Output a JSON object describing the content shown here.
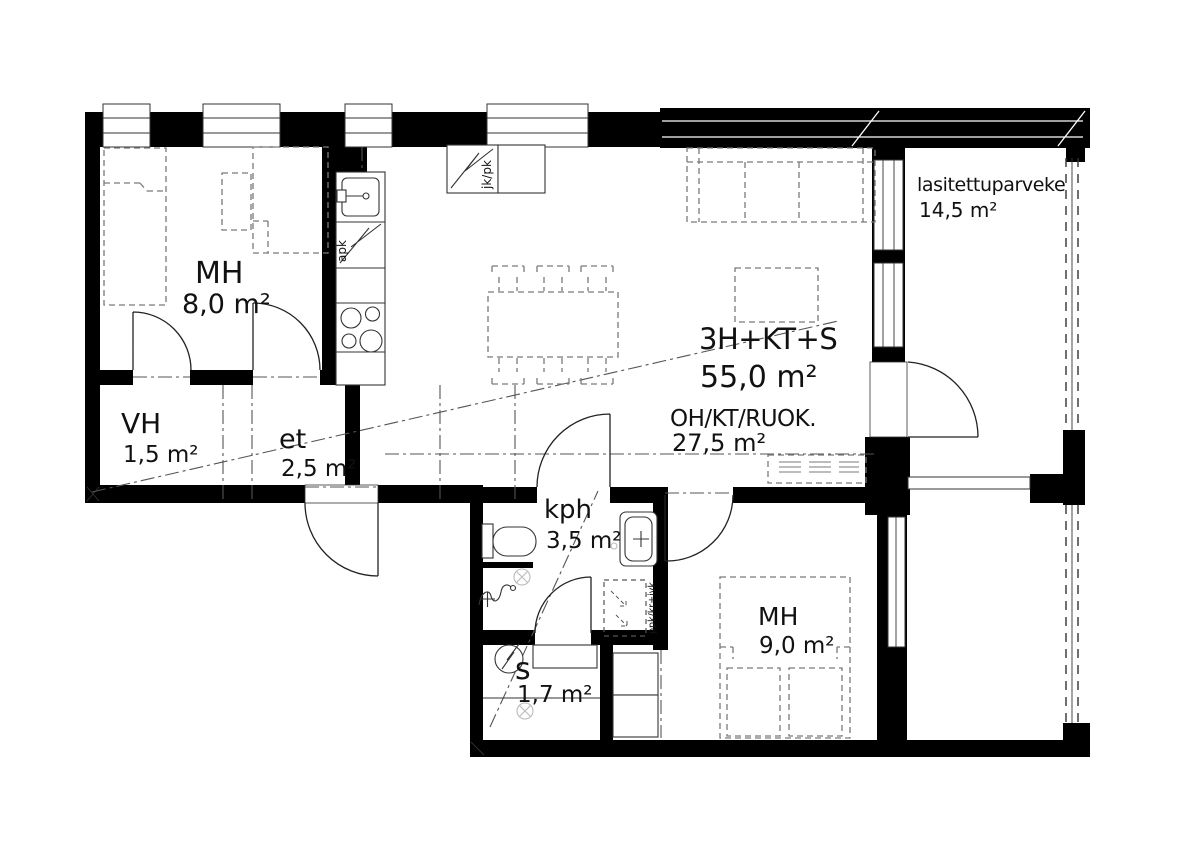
{
  "apartment": {
    "type_label": "3H+KT+S",
    "area": "55,0 m²"
  },
  "rooms": {
    "bedroom1": {
      "label": "MH",
      "area": "8,0 m²"
    },
    "closet": {
      "label": "VH",
      "area": "1,5 m²"
    },
    "entry": {
      "label": "et",
      "area": "2,5 m²"
    },
    "living": {
      "label": "OH/KT/RUOK.",
      "area": "27,5 m²"
    },
    "bathroom": {
      "label": "kph",
      "area": "3,5 m²"
    },
    "sauna": {
      "label": "s",
      "area": "1,7 m²"
    },
    "bedroom2": {
      "label": "MH",
      "area": "9,0 m²"
    },
    "balcony": {
      "label": "lasitettuparveke",
      "area": "14,5 m²"
    }
  },
  "appliances": {
    "fridge_freezer": "jk/pk",
    "dishwasher": "apk",
    "laundry_reservation": "ppk/kr+ivk"
  },
  "colors": {
    "wall": "#000000",
    "fixture_line": "#333333",
    "furniture_line": "#7a7a7a",
    "background": "#ffffff",
    "text": "#111111"
  }
}
